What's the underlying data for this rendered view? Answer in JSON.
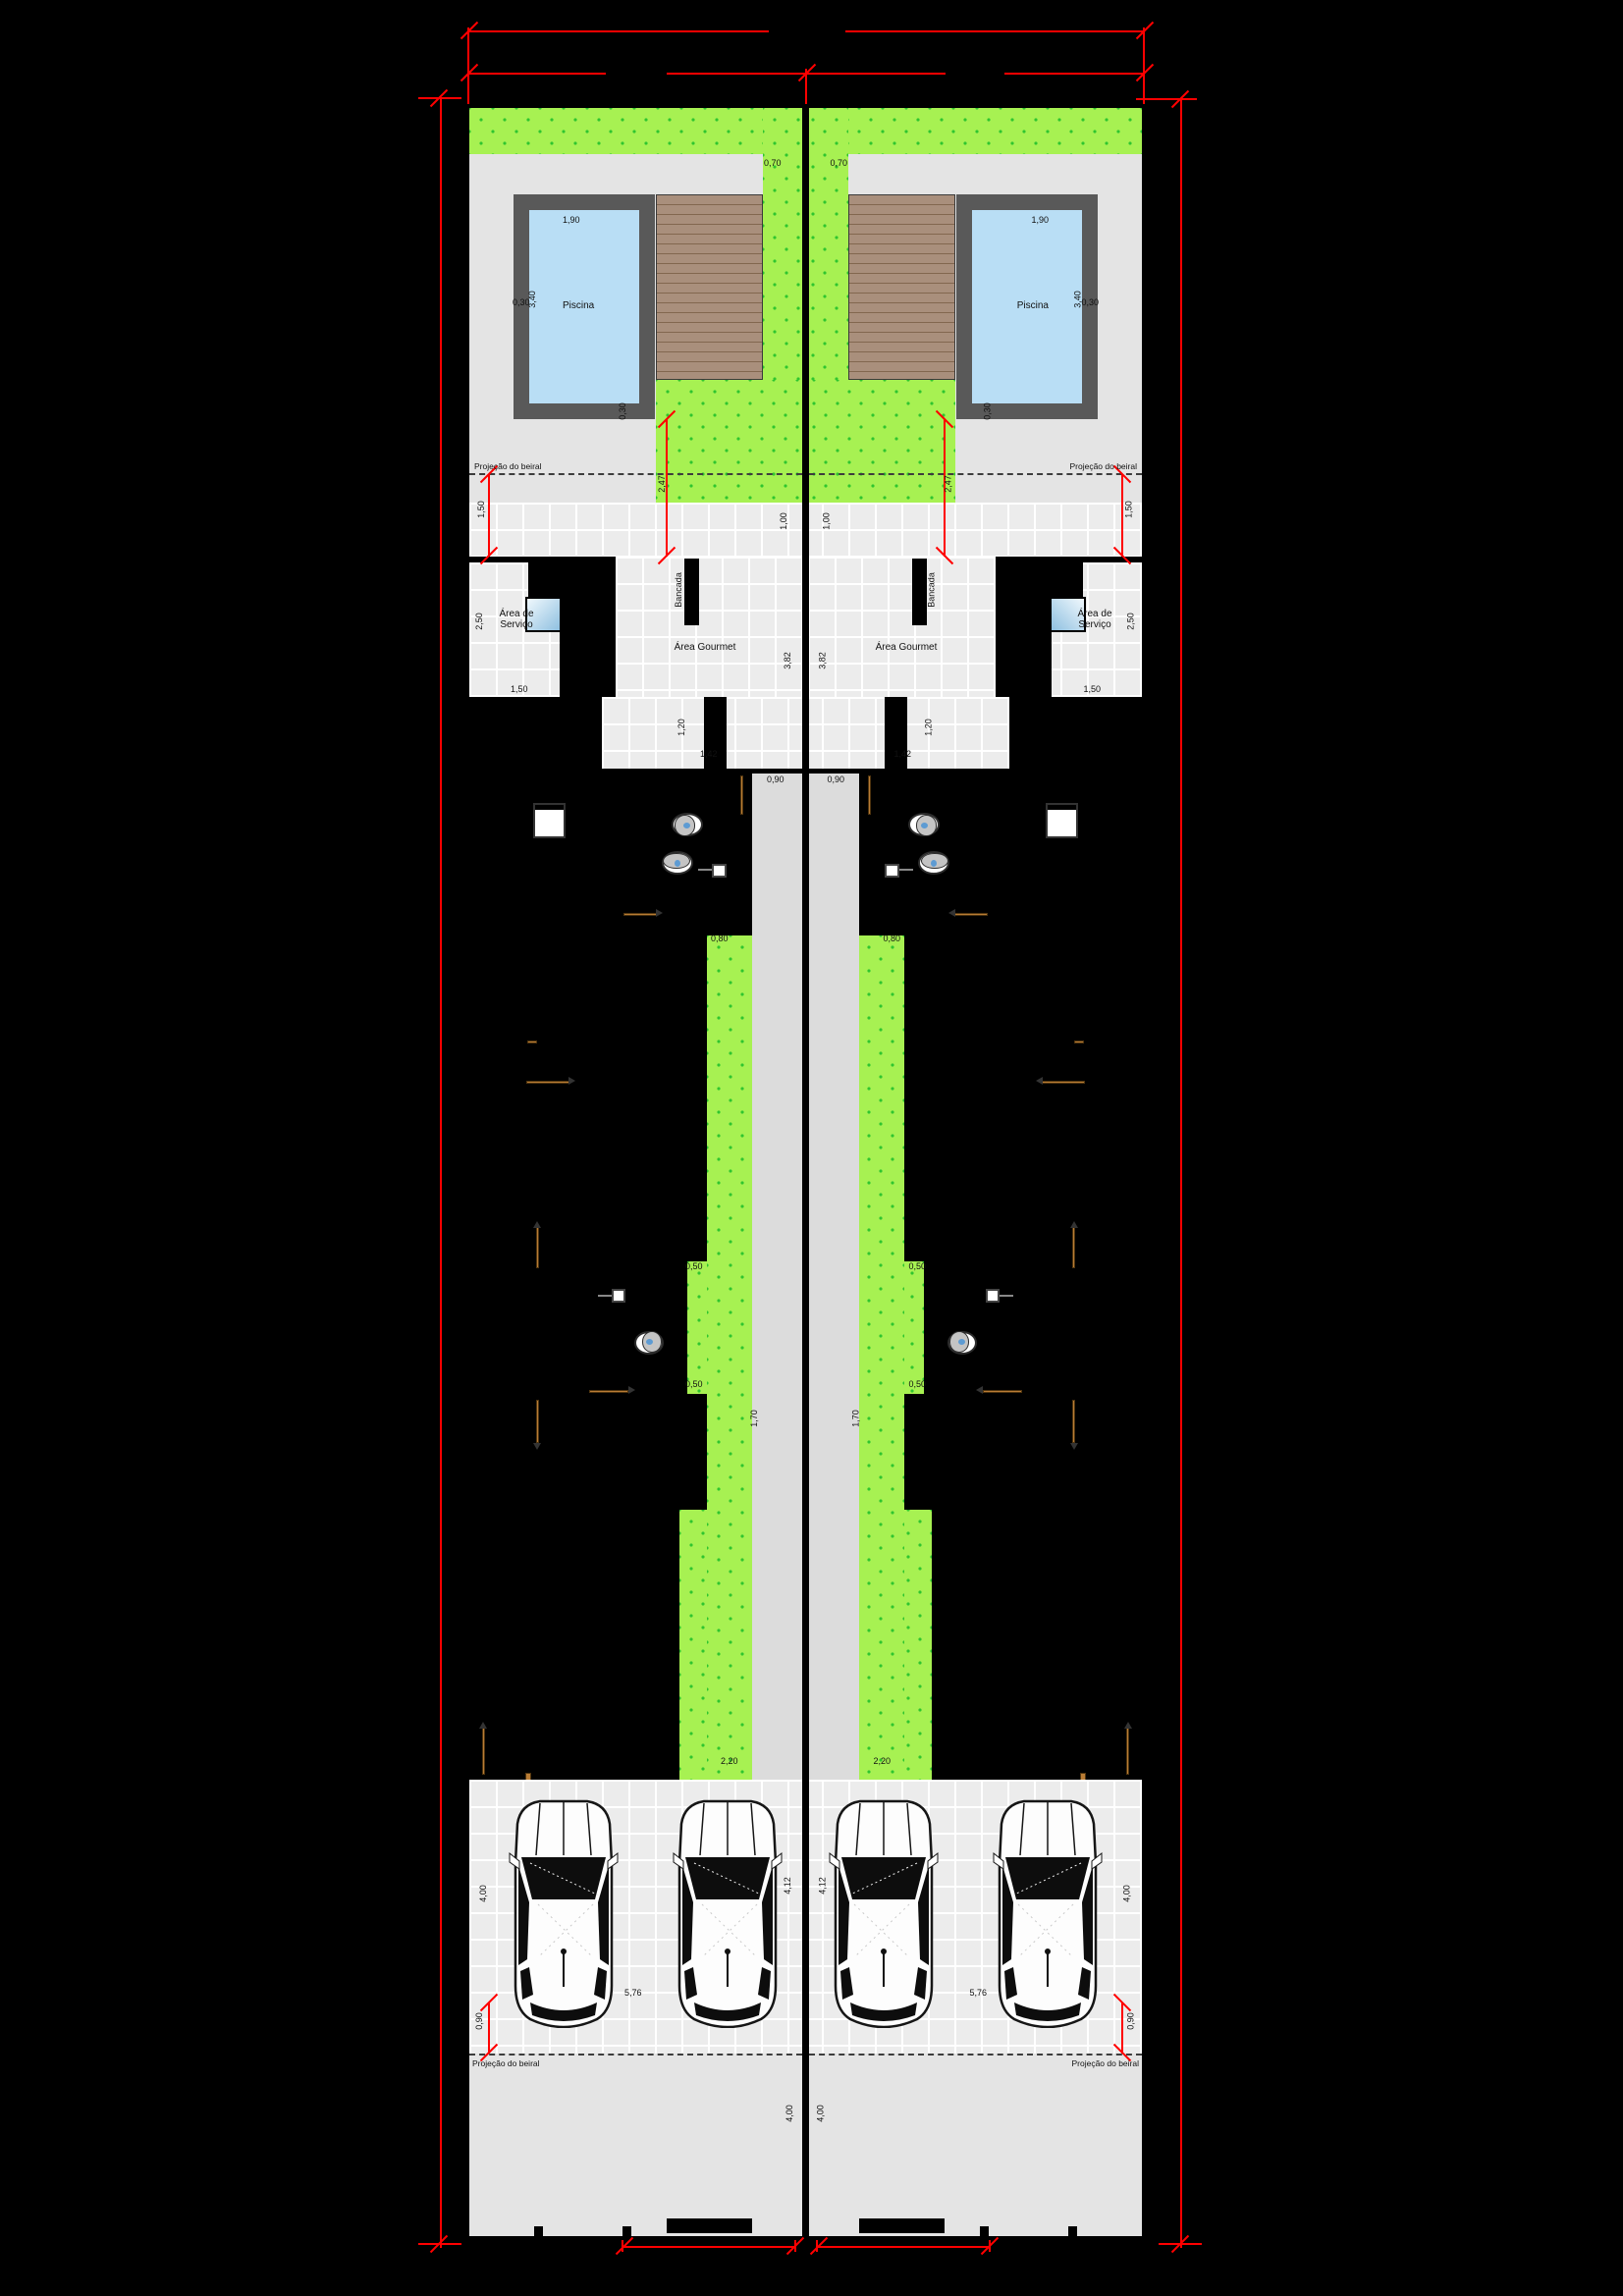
{
  "drawing": {
    "rooms": {
      "pool": "Piscina",
      "gourmet": "Área Gourmet",
      "service": "Área de Serviço",
      "counter": "Bancada"
    },
    "notes": {
      "eave_projection": "Projeção do beiral"
    },
    "dims": {
      "d030": "0,30",
      "d050": "0,50",
      "d070": "0,70",
      "d080": "0,80",
      "d090": "0,90",
      "d100": "1,00",
      "d120": "1,20",
      "d142": "1,42",
      "d150": "1,50",
      "d170": "1,70",
      "d190": "1,90",
      "d220": "2,20",
      "d247": "2,47",
      "d250": "2,50",
      "d340": "3,40",
      "d382": "3,82",
      "d400": "4,00",
      "d412": "4,12",
      "d576": "5,76"
    },
    "colors": {
      "dimension_red": "#ff0000",
      "lawn_green": "#a7f152",
      "lawn_dot_green": "#2fc52f",
      "pool_water_blue": "#b9def5",
      "pool_coping_gray": "#595959",
      "deck_wood_brown": "#a98f7c",
      "paving_gray": "#e4e4e4",
      "walkway_gray": "#dcdcdc",
      "door_wood_orange": "#b97c35",
      "background": "#000000"
    }
  }
}
